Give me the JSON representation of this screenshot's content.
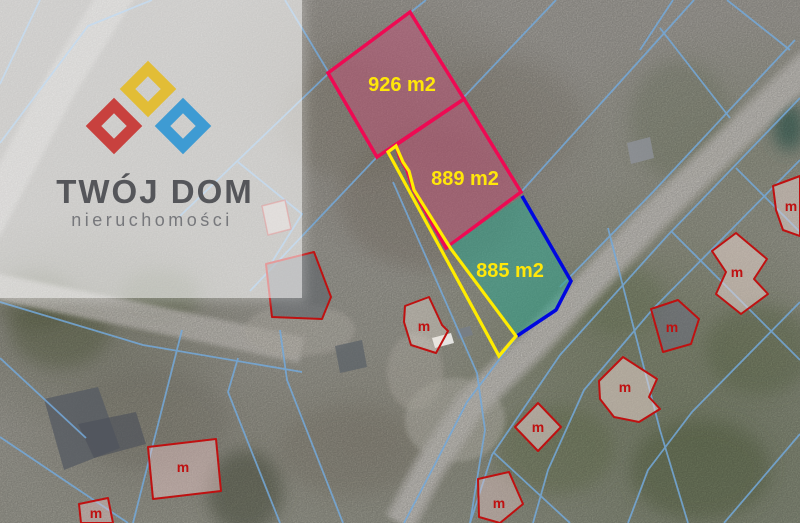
{
  "watermark": {
    "title": "TWÓJ DOM",
    "subtitle": "nieruchomości",
    "title_color": "#55565a",
    "subtitle_color": "#77787c",
    "diamond_red": "#c8413e",
    "diamond_yellow": "#e2bd36",
    "diamond_blue": "#3e9bd3"
  },
  "plots": [
    {
      "area_label": "926 m2",
      "fill": "#c25177",
      "outline": "#ee0a53"
    },
    {
      "area_label": "889 m2",
      "fill": "#c25177",
      "outline": "#ee0a53"
    },
    {
      "area_label": "885 m2",
      "fill": "#2fa38c",
      "outline": "#0007e0"
    }
  ],
  "area_label_color": "#ffe70a",
  "access_strip_outline": "#ffec00",
  "map": {
    "building_marker_label": "m",
    "building_outline_color": "#bf1111",
    "parcel_line_color": "#74a9da"
  }
}
